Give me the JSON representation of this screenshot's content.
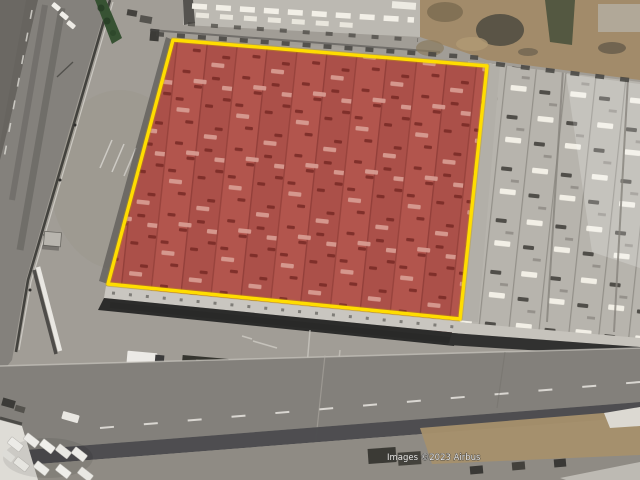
{
  "map": {
    "attribution": "Images ©2023 Airbus",
    "highlight": {
      "outline_points": "173,40 487,66 460,319 108,284",
      "fill_points": "173,40 487,66 458,334 373,322 108,284",
      "outline_color": "#ffdd00",
      "fill_color": "#b2554d",
      "roof_line_color": "#93403a",
      "vent_dark_color": "#7b2c27",
      "skylight_light_color": "#d89e94"
    },
    "neighbor_roof": {
      "base_color": "#b7b4ad",
      "skylight_color": "#f2efe6",
      "vent_color": "#45433e"
    },
    "attribution_color": "#e9e7e3"
  }
}
